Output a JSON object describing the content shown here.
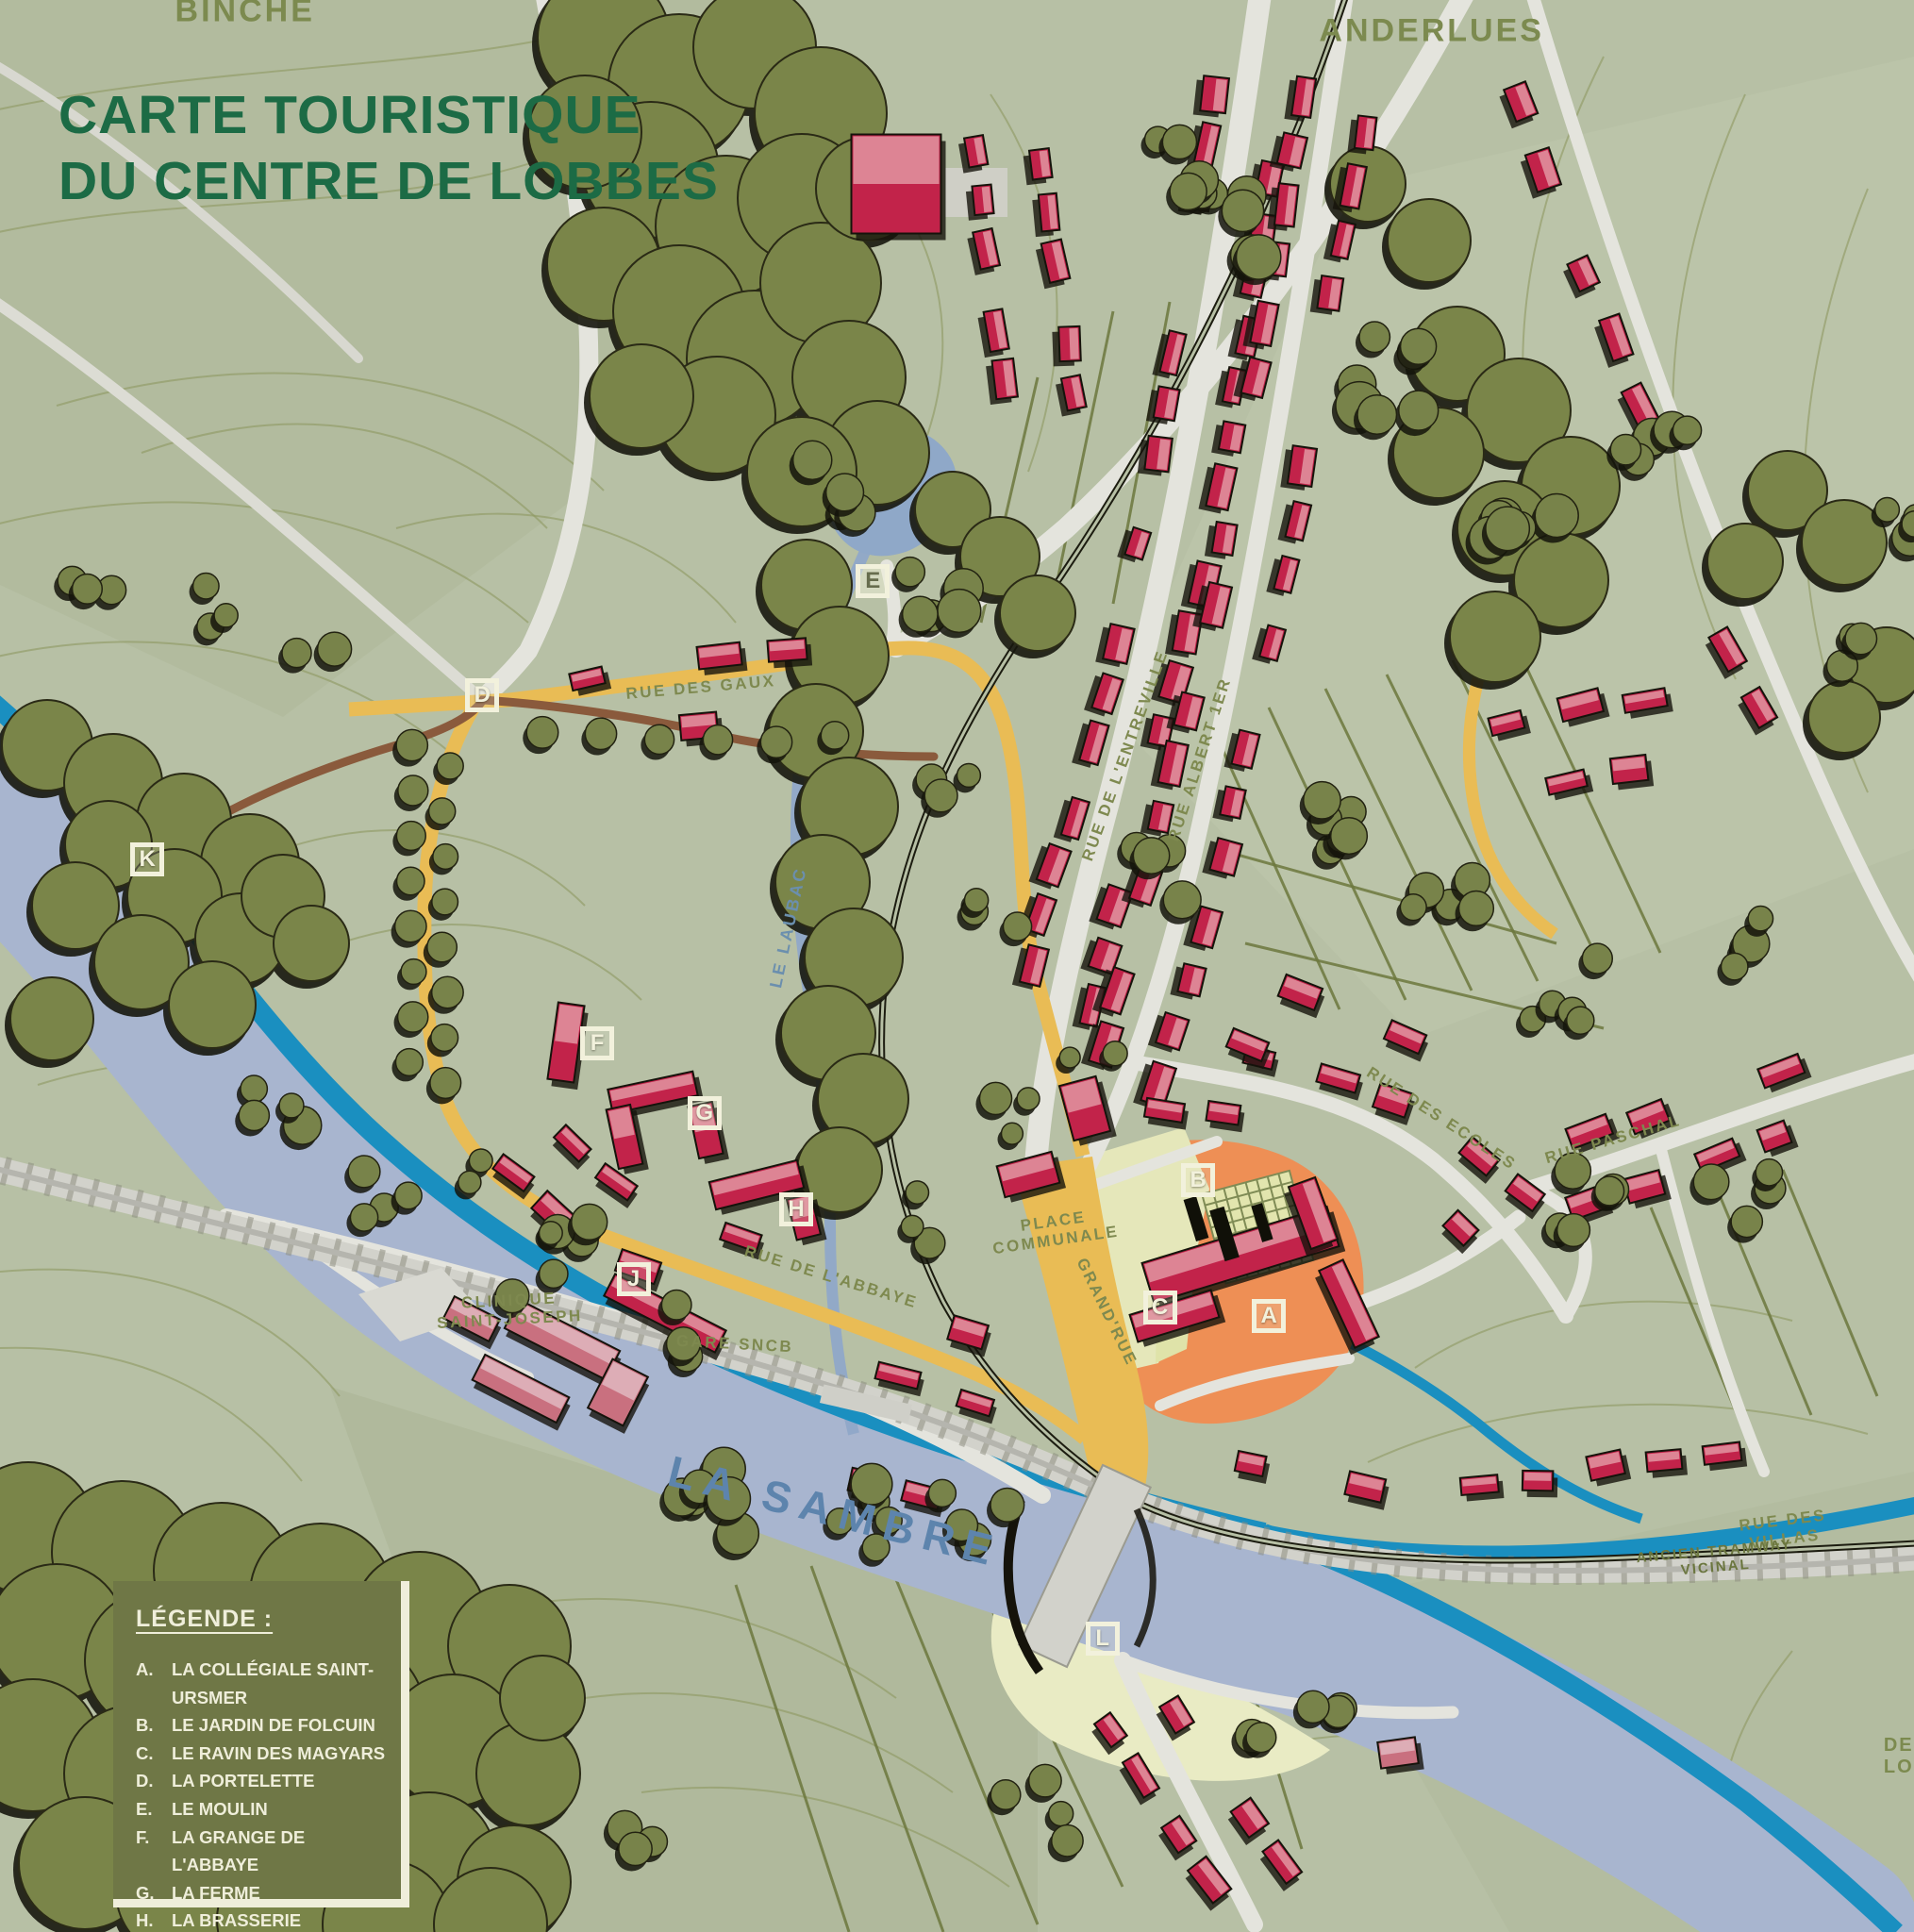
{
  "title": {
    "line1": "CARTE TOURISTIQUE",
    "line2": "DU CENTRE DE LOBBES"
  },
  "legend": {
    "title": "LÉGENDE :",
    "items": [
      {
        "key": "A.",
        "label": "LA COLLÉGIALE SAINT-URSMER"
      },
      {
        "key": "B.",
        "label": "LE JARDIN DE FOLCUIN"
      },
      {
        "key": "C.",
        "label": "LE RAVIN DES MAGYARS"
      },
      {
        "key": "D.",
        "label": "LA PORTELETTE"
      },
      {
        "key": "E.",
        "label": "LE MOULIN"
      },
      {
        "key": "F.",
        "label": "LA GRANGE DE L'ABBAYE"
      },
      {
        "key": "G.",
        "label": "LA FERME"
      },
      {
        "key": "H.",
        "label": "LA BRASSERIE"
      },
      {
        "key": "J.",
        "label": "LES COMMUNS"
      },
      {
        "key": "K.",
        "label": "LA PORTE MANDENNE"
      },
      {
        "key": "L.",
        "label": "LE RELAIS NAUTIQUE"
      }
    ]
  },
  "map_labels": [
    {
      "id": "binche",
      "text": "BINCHE",
      "x": 12.8,
      "y": 0.6,
      "rot": 0,
      "kind": "district"
    },
    {
      "id": "anderlues",
      "text": "ANDERLUES",
      "x": 74.8,
      "y": 1.6,
      "rot": 0,
      "kind": "district"
    },
    {
      "id": "rue-des-gaux",
      "text": "RUE DES GAUX",
      "x": 36.6,
      "y": 35.6,
      "rot": -5,
      "kind": "street"
    },
    {
      "id": "rue-de-lentreville",
      "text": "RUE DE L'ENTREVILLE",
      "x": 58.8,
      "y": 39.1,
      "rot": -70,
      "kind": "street"
    },
    {
      "id": "rue-albert-1er",
      "text": "RUE ALBERT 1ER",
      "x": 62.7,
      "y": 39.3,
      "rot": -72,
      "kind": "street"
    },
    {
      "id": "rue-des-ecoles",
      "text": "RUE DES ECOLES",
      "x": 75.3,
      "y": 57.9,
      "rot": 33,
      "kind": "street"
    },
    {
      "id": "rue-paschal",
      "text": "RUE PASCHAL",
      "x": 84.3,
      "y": 59.0,
      "rot": -16,
      "kind": "street"
    },
    {
      "id": "place-communale",
      "text": "PLACE\nCOMMUNALE",
      "x": 55.1,
      "y": 63.7,
      "rot": -8,
      "kind": "street"
    },
    {
      "id": "grand-rue",
      "text": "GRAND'RUE",
      "x": 57.8,
      "y": 67.9,
      "rot": 64,
      "kind": "street"
    },
    {
      "id": "rue-de-labbaye",
      "text": "RUE DE L'ABBAYE",
      "x": 43.4,
      "y": 66.1,
      "rot": 17,
      "kind": "street"
    },
    {
      "id": "clinique-saint-joseph",
      "text": "CLINIQUE\nSAINT-JOSEPH",
      "x": 26.6,
      "y": 67.8,
      "rot": -3,
      "kind": "street"
    },
    {
      "id": "gare-sncb",
      "text": "GARE SNCB",
      "x": 38.4,
      "y": 69.6,
      "rot": 3,
      "kind": "street"
    },
    {
      "id": "la-sambre",
      "text": "LA SAMBRE",
      "x": 43.6,
      "y": 78.2,
      "rot": 14,
      "kind": "water-big"
    },
    {
      "id": "le-laubac",
      "text": "LE LAUBAC",
      "x": 41.2,
      "y": 48.0,
      "rot": -78,
      "kind": "water-small"
    },
    {
      "id": "rue-des-villas",
      "text": "RUE DES VILLAS",
      "x": 93.2,
      "y": 79.2,
      "rot": -7,
      "kind": "street"
    },
    {
      "id": "ancien-tramway-vicinal",
      "text": "ANCIEN TRAMWAY VICINAL",
      "x": 89.6,
      "y": 80.7,
      "rot": -5,
      "kind": "street-dark"
    },
    {
      "id": "de-lo",
      "text": "DE LO",
      "x": 99.2,
      "y": 90.9,
      "rot": 0,
      "kind": "district-small"
    }
  ],
  "markers": [
    {
      "letter": "A",
      "x": 66.3,
      "y": 68.1
    },
    {
      "letter": "B",
      "x": 62.6,
      "y": 61.1
    },
    {
      "letter": "C",
      "x": 60.6,
      "y": 67.7
    },
    {
      "letter": "D",
      "x": 25.2,
      "y": 36.0
    },
    {
      "letter": "E",
      "x": 45.6,
      "y": 30.1,
      "variant": "light"
    },
    {
      "letter": "F",
      "x": 31.2,
      "y": 54.0
    },
    {
      "letter": "G",
      "x": 36.8,
      "y": 57.6
    },
    {
      "letter": "H",
      "x": 41.6,
      "y": 62.6
    },
    {
      "letter": "J",
      "x": 33.1,
      "y": 66.2
    },
    {
      "letter": "K",
      "x": 7.7,
      "y": 44.5
    },
    {
      "letter": "L",
      "x": 57.6,
      "y": 84.8
    }
  ],
  "colors": {
    "title_green": "#1c6b45",
    "district_olive": "#7c8a4f",
    "building_red": "#c2234a",
    "road_yellow": "#e9bc55",
    "river_blue": "#a8b5cf",
    "canal_blue": "#1a8fc0",
    "forest_green": "#7a8549",
    "field_green": "#b7c0a5",
    "orange_zone": "#ee8f55",
    "legend_bg": "#6f7746",
    "legend_text": "#efeeda"
  }
}
